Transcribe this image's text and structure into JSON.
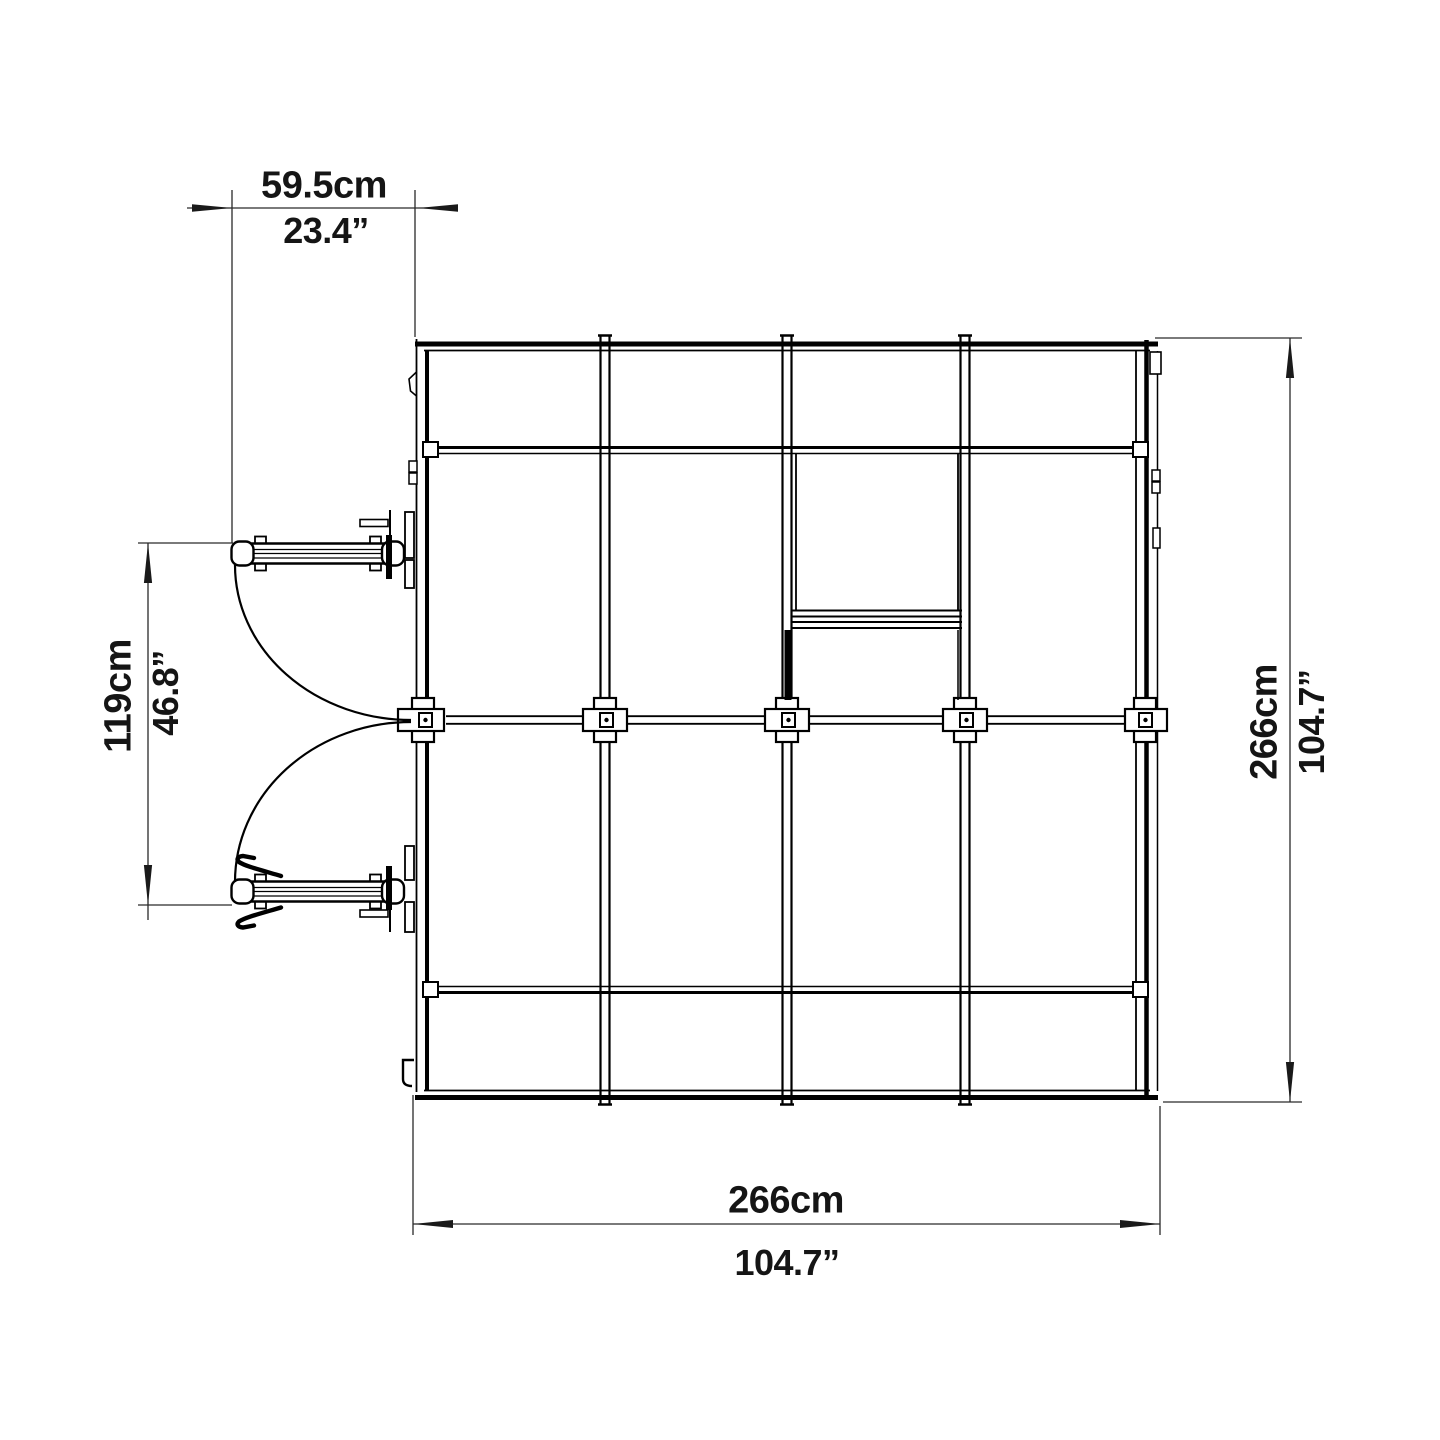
{
  "page": {
    "background": "#ffffff",
    "line_color": "#000000",
    "dimension_line_color": "#2a2a2a",
    "text_color": "#151515"
  },
  "drawing": {
    "name": "greenhouse-top-view-plan",
    "labels": {
      "door_width_metric": "59.5cm",
      "door_width_imperial": "23.4”",
      "door_opening_metric": "119cm",
      "door_opening_imperial": "46.8”",
      "depth_metric": "266cm",
      "depth_imperial": "104.7”",
      "width_metric": "266cm",
      "width_imperial": "104.7”"
    }
  }
}
